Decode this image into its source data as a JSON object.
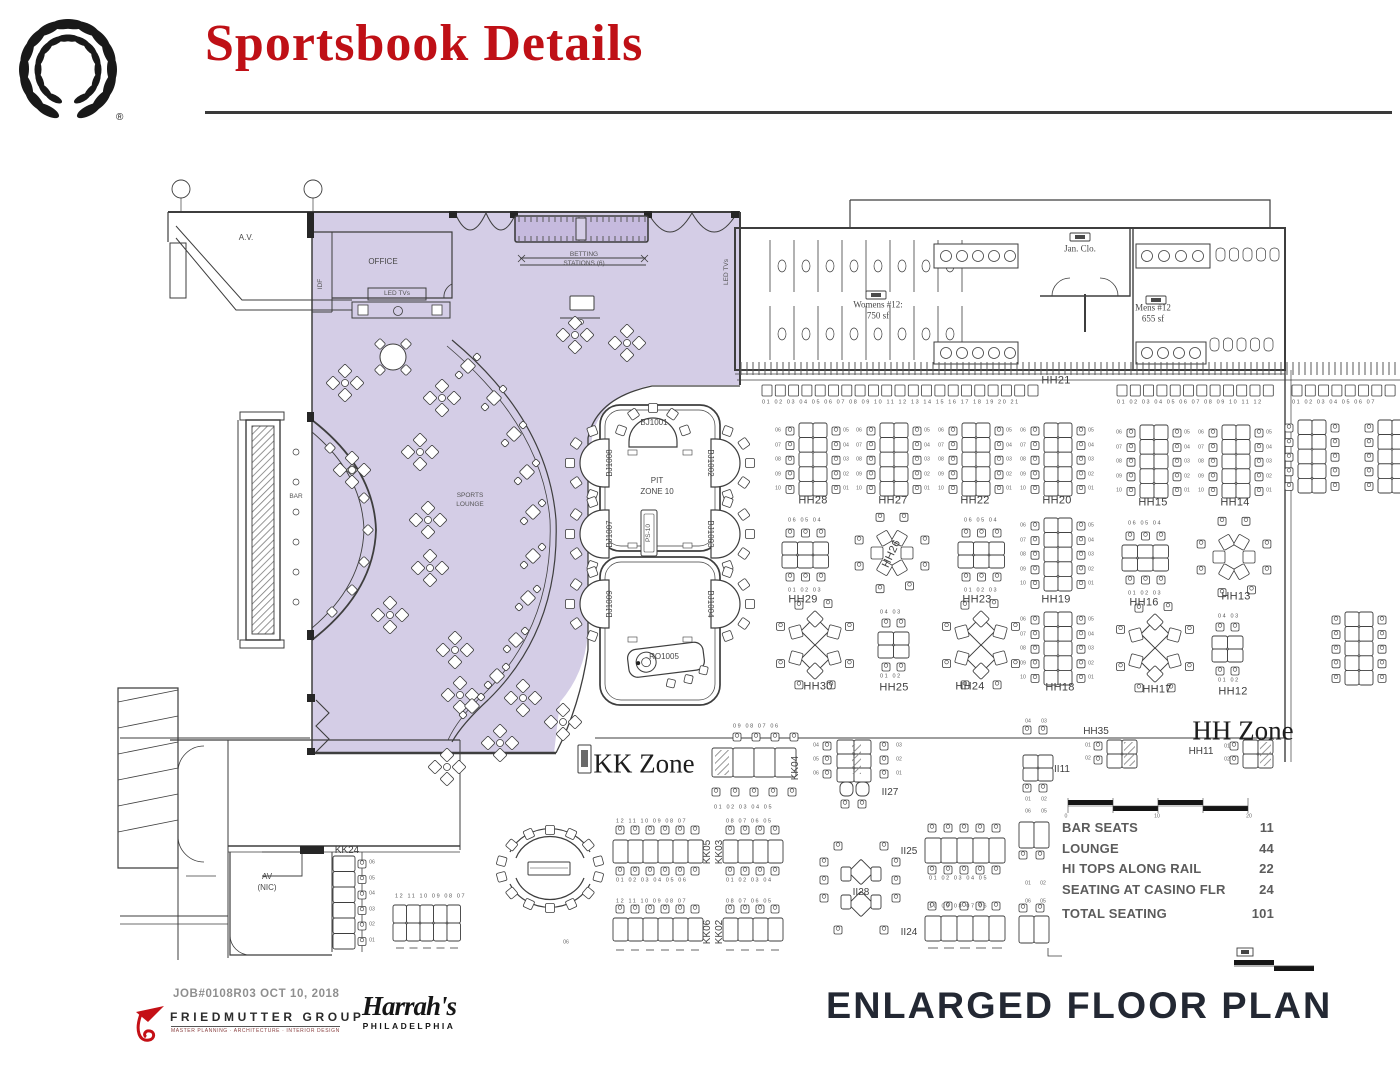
{
  "slide": {
    "title": "Sportsbook Details",
    "registered": "®"
  },
  "footer": {
    "job": "JOB#0108R03 OCT 10, 2018",
    "firm": "FRIEDMUTTER GROUP",
    "firm_tagline": "MASTER PLANNING · ARCHITECTURE · INTERIOR DESIGN",
    "client_name": "Harrah's",
    "client_city": "PHILADELPHIA",
    "plan_title": "ENLARGED FLOOR PLAN"
  },
  "seating_table": {
    "rows": [
      {
        "label": "BAR SEATS",
        "value": "11"
      },
      {
        "label": "LOUNGE",
        "value": "44"
      },
      {
        "label": "HI TOPS ALONG RAIL",
        "value": "22"
      },
      {
        "label": "SEATING AT CASINO FLR",
        "value": "24"
      },
      {
        "label": "TOTAL SEATING",
        "value": "101",
        "total": true
      }
    ]
  },
  "plan": {
    "seqs": {
      "bank_left": "06 07 08 09 10",
      "bank_right": "05 04 03 02 01",
      "kk24_col": "06 05 04 03 02 01"
    },
    "labels": [
      {
        "t": "A.V.",
        "x": 246,
        "y": 238,
        "c": "xs",
        "n": "room-av"
      },
      {
        "t": "OFFICE",
        "x": 383,
        "y": 262,
        "c": "xs",
        "n": "room-office"
      },
      {
        "t": "IDF",
        "x": 321,
        "y": 284,
        "r": -90,
        "c": "xxs",
        "n": "room-idf"
      },
      {
        "t": "LED TVs",
        "x": 397,
        "y": 294,
        "c": "xxs"
      },
      {
        "t": "BETTING",
        "x": 584,
        "y": 255,
        "c": "xxs"
      },
      {
        "t": "STATIONS (6)",
        "x": 584,
        "y": 264,
        "c": "xxs"
      },
      {
        "t": "LED TVs",
        "x": 727,
        "y": 272,
        "r": -90,
        "c": "xxs"
      },
      {
        "t": "Womens #12:",
        "x": 878,
        "y": 305,
        "c": "ser",
        "n": "room-womens"
      },
      {
        "t": "750 sf",
        "x": 878,
        "y": 316,
        "c": "ser"
      },
      {
        "t": "Jan. Clo.",
        "x": 1080,
        "y": 249,
        "c": "ser",
        "n": "room-jan-closet"
      },
      {
        "t": "Mens #12",
        "x": 1153,
        "y": 308,
        "c": "ser",
        "n": "room-mens"
      },
      {
        "t": "655 sf",
        "x": 1153,
        "y": 319,
        "c": "ser"
      },
      {
        "t": "BAR",
        "x": 296,
        "y": 497,
        "c": "xxs",
        "n": "bar-label"
      },
      {
        "t": "SPORTS",
        "x": 470,
        "y": 496,
        "c": "xxs",
        "n": "sports-lounge-label"
      },
      {
        "t": "LOUNGE",
        "x": 470,
        "y": 505,
        "c": "xxs"
      },
      {
        "t": "AV",
        "x": 267,
        "y": 877,
        "c": "xs",
        "n": "room-av-nic"
      },
      {
        "t": "(NIC)",
        "x": 267,
        "y": 888,
        "c": "xs"
      },
      {
        "t": "BJ1001",
        "x": 654,
        "y": 423,
        "c": "xs"
      },
      {
        "t": "BJ1008",
        "x": 610,
        "y": 463,
        "r": -90,
        "c": "xs"
      },
      {
        "t": "BJ1007",
        "x": 610,
        "y": 534,
        "r": -90,
        "c": "xs"
      },
      {
        "t": "BJ1009",
        "x": 610,
        "y": 604,
        "r": -90,
        "c": "xs"
      },
      {
        "t": "BJ1002",
        "x": 710,
        "y": 463,
        "r": 90,
        "c": "xs"
      },
      {
        "t": "BJ1003",
        "x": 710,
        "y": 534,
        "r": 90,
        "c": "xs"
      },
      {
        "t": "BJ1004",
        "x": 710,
        "y": 604,
        "r": 90,
        "c": "xs"
      },
      {
        "t": "PIT",
        "x": 657,
        "y": 481,
        "c": "xs",
        "n": "pit-zone-label"
      },
      {
        "t": "ZONE 10",
        "x": 657,
        "y": 492,
        "c": "xs"
      },
      {
        "t": "PS-10",
        "x": 649,
        "y": 533,
        "r": -90,
        "c": "xxs"
      },
      {
        "t": "RO1005",
        "x": 664,
        "y": 657,
        "c": "xs"
      },
      {
        "t": "HH21",
        "x": 1056,
        "y": 381,
        "c": "bank"
      },
      {
        "t": "HH28",
        "x": 813,
        "y": 501,
        "c": "bank"
      },
      {
        "t": "HH27",
        "x": 893,
        "y": 501,
        "c": "bank"
      },
      {
        "t": "HH22",
        "x": 975,
        "y": 501,
        "c": "bank"
      },
      {
        "t": "HH20",
        "x": 1057,
        "y": 501,
        "c": "bank"
      },
      {
        "t": "HH15",
        "x": 1153,
        "y": 503,
        "c": "bank"
      },
      {
        "t": "HH14",
        "x": 1235,
        "y": 503,
        "c": "bank"
      },
      {
        "t": "HH29",
        "x": 803,
        "y": 600,
        "c": "bank"
      },
      {
        "t": "HH26",
        "x": 892,
        "y": 554,
        "r": -65,
        "c": "bank"
      },
      {
        "t": "HH23",
        "x": 977,
        "y": 600,
        "c": "bank"
      },
      {
        "t": "HH19",
        "x": 1056,
        "y": 600,
        "c": "bank"
      },
      {
        "t": "HH16",
        "x": 1144,
        "y": 603,
        "c": "bank"
      },
      {
        "t": "HH13",
        "x": 1236,
        "y": 597,
        "c": "bank"
      },
      {
        "t": "HH30",
        "x": 818,
        "y": 687,
        "c": "bank"
      },
      {
        "t": "HH25",
        "x": 894,
        "y": 688,
        "c": "bank"
      },
      {
        "t": "HH24",
        "x": 970,
        "y": 687,
        "c": "bank"
      },
      {
        "t": "HH18",
        "x": 1060,
        "y": 688,
        "c": "bank"
      },
      {
        "t": "HH17",
        "x": 1157,
        "y": 690,
        "c": "bank"
      },
      {
        "t": "HH12",
        "x": 1233,
        "y": 692,
        "c": "bank"
      },
      {
        "t": "HH35",
        "x": 1096,
        "y": 732,
        "c": "bank-s"
      },
      {
        "t": "HH11",
        "x": 1201,
        "y": 752,
        "c": "bank-s"
      },
      {
        "t": "II11",
        "x": 1062,
        "y": 770,
        "c": "bank-s"
      },
      {
        "t": "II27",
        "x": 890,
        "y": 793,
        "c": "bank-s"
      },
      {
        "t": "II25",
        "x": 909,
        "y": 852,
        "c": "bank-s"
      },
      {
        "t": "II28",
        "x": 861,
        "y": 893,
        "c": "bank-s"
      },
      {
        "t": "II24",
        "x": 909,
        "y": 933,
        "c": "bank-s"
      },
      {
        "t": "KK24",
        "x": 347,
        "y": 851,
        "c": "bank-s"
      },
      {
        "t": "KK04",
        "x": 796,
        "y": 768,
        "r": -90,
        "c": "bank-s"
      },
      {
        "t": "KK05",
        "x": 708,
        "y": 852,
        "r": -90,
        "c": "bank-s"
      },
      {
        "t": "KK03",
        "x": 720,
        "y": 852,
        "r": -90,
        "c": "bank-s"
      },
      {
        "t": "KK06",
        "x": 708,
        "y": 932,
        "r": -90,
        "c": "bank-s"
      },
      {
        "t": "KK02",
        "x": 720,
        "y": 932,
        "r": -90,
        "c": "bank-s"
      },
      {
        "t": "KK Zone",
        "x": 644,
        "y": 764,
        "c": "zone",
        "n": "kk-zone-label"
      },
      {
        "t": "HH Zone",
        "x": 1243,
        "y": 731,
        "c": "zone",
        "n": "hh-zone-label"
      },
      {
        "t": "01 02 03 04 05 06 07 08 09 10 11 12 13 14 15 16 17 18 19 20 21",
        "x": 762,
        "y": 403,
        "c": "strip"
      },
      {
        "t": "01 02 03 04 05 06 07 08 09 10 11 12",
        "x": 1117,
        "y": 403,
        "c": "strip"
      },
      {
        "t": "01 02 03 04 05 06 07",
        "x": 1292,
        "y": 403,
        "c": "strip"
      },
      {
        "t": "06 05 04",
        "x": 788,
        "y": 521,
        "c": "strip"
      },
      {
        "t": "06 05 04",
        "x": 964,
        "y": 521,
        "c": "strip"
      },
      {
        "t": "06 05 04",
        "x": 1128,
        "y": 524,
        "c": "strip"
      },
      {
        "t": "01 02 03",
        "x": 788,
        "y": 591,
        "c": "strip"
      },
      {
        "t": "01 02 03",
        "x": 964,
        "y": 591,
        "c": "strip"
      },
      {
        "t": "01 02 03",
        "x": 1128,
        "y": 594,
        "c": "strip"
      },
      {
        "t": "04 03",
        "x": 880,
        "y": 613,
        "c": "strip"
      },
      {
        "t": "01 02",
        "x": 880,
        "y": 677,
        "c": "strip"
      },
      {
        "t": "04 03",
        "x": 1218,
        "y": 617,
        "c": "strip"
      },
      {
        "t": "01 02",
        "x": 1218,
        "y": 681,
        "c": "strip"
      },
      {
        "t": "09 08 07 06",
        "x": 733,
        "y": 727,
        "c": "strip"
      },
      {
        "t": "01 02 03 04 05",
        "x": 714,
        "y": 808,
        "c": "strip"
      },
      {
        "t": "12 11 10 09 08 07",
        "x": 616,
        "y": 822,
        "c": "strip"
      },
      {
        "t": "01 02 03 04 05 06",
        "x": 616,
        "y": 881,
        "c": "strip"
      },
      {
        "t": "08 07 06 05",
        "x": 726,
        "y": 822,
        "c": "strip"
      },
      {
        "t": "01 02 03 04",
        "x": 726,
        "y": 881,
        "c": "strip"
      },
      {
        "t": "12 11 10 09 08 07",
        "x": 616,
        "y": 902,
        "c": "strip"
      },
      {
        "t": "08 07 06 05",
        "x": 726,
        "y": 902,
        "c": "strip"
      },
      {
        "t": "12 11 10 09 08 07",
        "x": 395,
        "y": 897,
        "c": "strip"
      },
      {
        "t": "01 02 03 04 05",
        "x": 929,
        "y": 879,
        "c": "strip"
      },
      {
        "t": "10 09 08 07 06",
        "x": 929,
        "y": 907,
        "c": "strip"
      },
      {
        "t": "04",
        "x": 816,
        "y": 746,
        "c": "num"
      },
      {
        "t": "05",
        "x": 816,
        "y": 760,
        "c": "num"
      },
      {
        "t": "06",
        "x": 816,
        "y": 774,
        "c": "num"
      },
      {
        "t": "03",
        "x": 899,
        "y": 746,
        "c": "num"
      },
      {
        "t": "02",
        "x": 899,
        "y": 760,
        "c": "num"
      },
      {
        "t": "01",
        "x": 899,
        "y": 774,
        "c": "num"
      },
      {
        "t": "04",
        "x": 1028,
        "y": 722,
        "c": "num"
      },
      {
        "t": "03",
        "x": 1044,
        "y": 722,
        "c": "num"
      },
      {
        "t": "01",
        "x": 1028,
        "y": 800,
        "c": "num"
      },
      {
        "t": "02",
        "x": 1044,
        "y": 800,
        "c": "num"
      },
      {
        "t": "06",
        "x": 1028,
        "y": 812,
        "c": "num"
      },
      {
        "t": "05",
        "x": 1044,
        "y": 812,
        "c": "num"
      },
      {
        "t": "01",
        "x": 1028,
        "y": 884,
        "c": "num"
      },
      {
        "t": "02",
        "x": 1043,
        "y": 884,
        "c": "num"
      },
      {
        "t": "06",
        "x": 1028,
        "y": 902,
        "c": "num"
      },
      {
        "t": "05",
        "x": 1043,
        "y": 902,
        "c": "num"
      },
      {
        "t": "01",
        "x": 1088,
        "y": 746,
        "c": "num"
      },
      {
        "t": "02",
        "x": 1088,
        "y": 759,
        "c": "num"
      },
      {
        "t": "01",
        "x": 1227,
        "y": 747,
        "c": "num"
      },
      {
        "t": "02",
        "x": 1227,
        "y": 760,
        "c": "num"
      },
      {
        "t": "06",
        "x": 566,
        "y": 943,
        "c": "num"
      },
      {
        "t": "0",
        "x": 1066,
        "y": 817,
        "c": "num"
      },
      {
        "t": "10",
        "x": 1157,
        "y": 817,
        "c": "num"
      },
      {
        "t": "20",
        "x": 1249,
        "y": 817,
        "c": "num"
      }
    ]
  }
}
